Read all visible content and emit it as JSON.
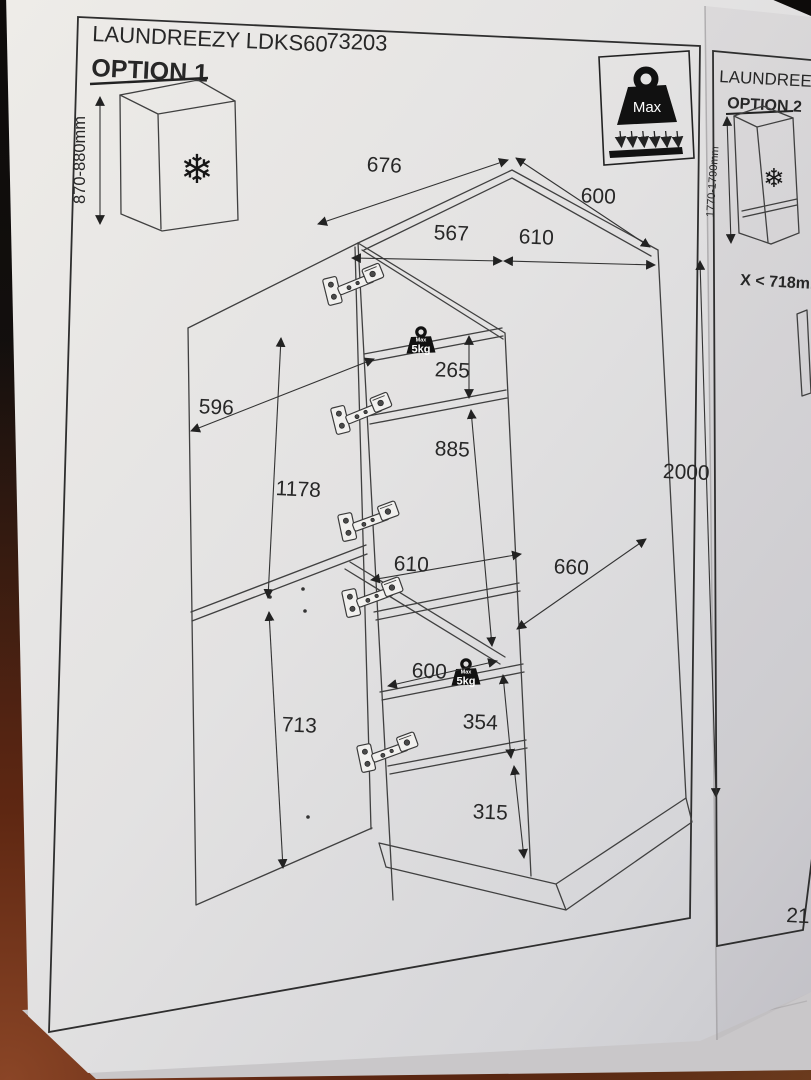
{
  "icons": {
    "snowflake": "❄"
  },
  "page1": {
    "title": "LAUNDREEZY LDKS60",
    "code": "73203",
    "option_label": "OPTION 1",
    "freezer_height_range": "870-880mm",
    "max_load": {
      "label": "Max"
    },
    "shelf_badges": [
      {
        "max_label": "Max",
        "weight": "5kg"
      },
      {
        "max_label": "Max",
        "weight": "5kg"
      }
    ],
    "dims": {
      "top_width": "676",
      "top_depth": "600",
      "top_inner_front": "567",
      "top_inner_side": "610",
      "top_clearance": "265",
      "appliance_height": "885",
      "door_width": "596",
      "upper_door_height": "1178",
      "mid_shelf_width": "610",
      "inner_depth": "660",
      "total_height": "2000",
      "lower_shelf_width": "600",
      "shelf_spacing": "354",
      "lower_door_height": "713",
      "bottom_spacing": "315"
    }
  },
  "page2": {
    "title": "LAUNDREEZY LDKS60",
    "option_label": "OPTION 2",
    "height_range": "1770-1790mm",
    "constraint": "X < 718mm",
    "page_number": "21"
  }
}
